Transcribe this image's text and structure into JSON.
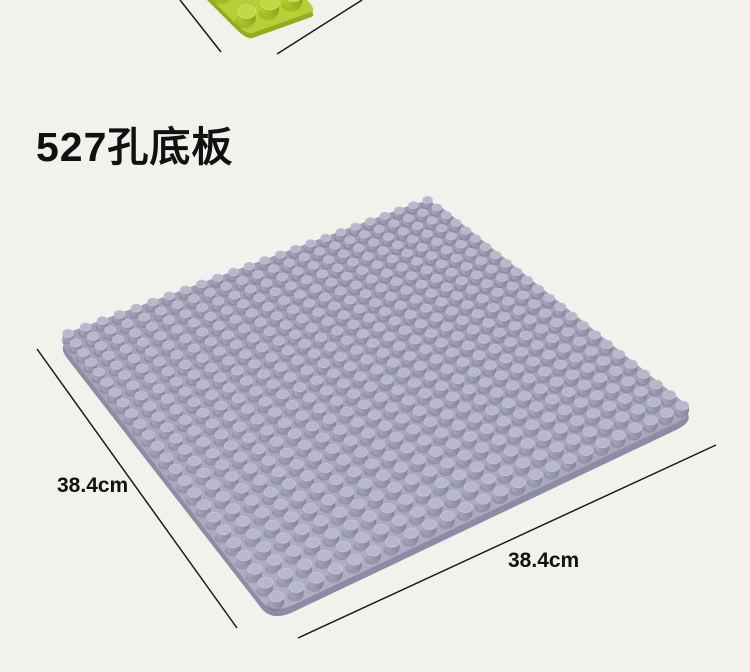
{
  "page": {
    "background": "#f2f1eb",
    "title": "527孔底板"
  },
  "dimensions": {
    "left_label": "38.4cm",
    "bottom_label": "38.4cm"
  },
  "figure": {
    "line_color": "#1b1b1b",
    "line_width": 1.5,
    "dimension_lines": [
      {
        "name": "green-plate-left-dim-line",
        "x1": 180,
        "y1": 0,
        "x2": 221,
        "y2": 52
      },
      {
        "name": "green-plate-right-dim-line",
        "x1": 362,
        "y1": 0,
        "x2": 277,
        "y2": 54
      },
      {
        "name": "gray-plate-left-dim-line",
        "x1": 37,
        "y1": 349,
        "x2": 237,
        "y2": 628
      },
      {
        "name": "gray-plate-bottom-dim-line",
        "x1": 298,
        "y1": 638,
        "x2": 716,
        "y2": 445
      }
    ],
    "plates": [
      {
        "name": "green-baseplate-corner",
        "corners": {
          "top": [
            173,
            -134
          ],
          "right": [
            317,
            10
          ],
          "bottom": [
            247,
            35
          ],
          "left": [
            103,
            -109
          ]
        },
        "grid_u": 6,
        "grid_v": 3,
        "stud_ratio": 0.62,
        "stud_height": 0.8,
        "thickness": 5,
        "corner_round": 0.08,
        "colors": {
          "base_far": "#aec62c",
          "base_near": "#b9d038",
          "side": "#93ab1f",
          "stud_side_light": "#b2ca2e",
          "stud_side_dark": "#8ea61d",
          "stud_top": "#c3d847",
          "stud_top_rim": "#cfe060",
          "shadow": "#70860f"
        }
      },
      {
        "name": "gray-baseplate",
        "corners": {
          "top": [
            430,
            198
          ],
          "right": [
            697,
            413
          ],
          "bottom": [
            272,
            615
          ],
          "left": [
            56,
            337
          ]
        },
        "grid_u": 24,
        "grid_v": 24,
        "stud_ratio": 0.74,
        "stud_height": 0.9,
        "thickness": 7,
        "corner_round": 0.05,
        "colors": {
          "base_far": "#9c9bb1",
          "base_near": "#b0afc3",
          "side": "#8d8ca4",
          "stud_side_light": "#a7a6bb",
          "stud_side_dark": "#8786a0",
          "stud_top": "#b9b8ca",
          "stud_top_rim": "#c6c5d6",
          "shadow": "#5e5d78"
        }
      }
    ]
  }
}
